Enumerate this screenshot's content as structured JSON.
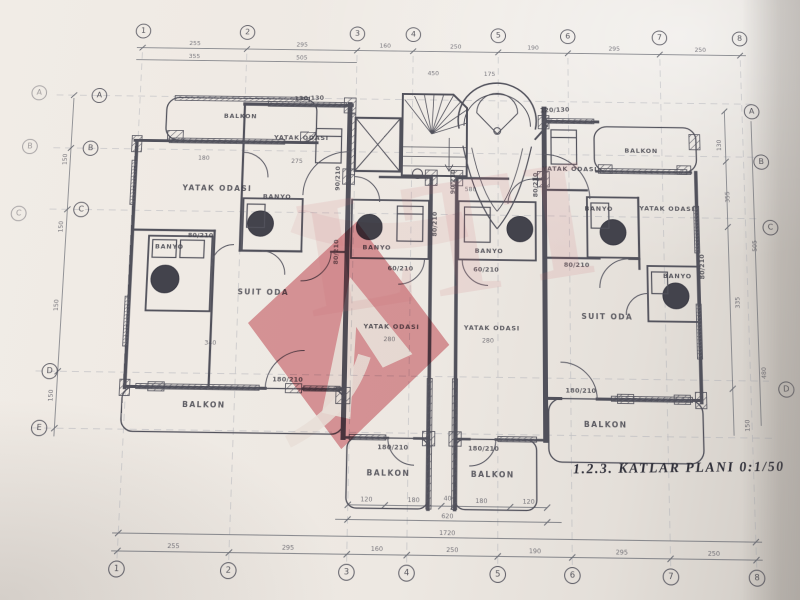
{
  "title": "1.2.3.  KATLAR  PLANI   0:1/50",
  "room_labels": {
    "balkon": "BALKON",
    "yatak_odasi": "YATAK ODASI",
    "banyo": "BANYO",
    "suit_oda": "SUIT ODA"
  },
  "openings": {
    "door_80": "80/210",
    "door_60": "60/210",
    "door_90": "90/210",
    "balcony_door_180": "180/210",
    "window_130": "130/130",
    "window_120": "120/130"
  },
  "grid_axes": {
    "columns": [
      "1",
      "2",
      "3",
      "4",
      "5",
      "6",
      "7",
      "8"
    ],
    "rows": [
      "A",
      "B",
      "C",
      "D",
      "E"
    ]
  },
  "dimensions": {
    "top_chain": [
      "255",
      "295",
      "160",
      "250",
      "190",
      "295",
      "250"
    ],
    "bottom_chain": [
      "255",
      "295",
      "160",
      "250",
      "190",
      "295",
      "250"
    ],
    "balcony_chain": [
      "120",
      "180",
      "40",
      "180",
      "120"
    ],
    "total_width": "1720",
    "center_total": "620",
    "upper_inner": [
      "355",
      "505",
      "450",
      "175"
    ],
    "left_chain": [
      "150",
      "150",
      "150",
      "150"
    ],
    "right_chain": [
      "130",
      "355",
      "335",
      "150",
      "505",
      "480"
    ],
    "interior": [
      "280",
      "280",
      "580",
      "340",
      "275",
      "180"
    ]
  },
  "watermark": {
    "accent_color": "#c8404e",
    "letters": "LTI"
  }
}
